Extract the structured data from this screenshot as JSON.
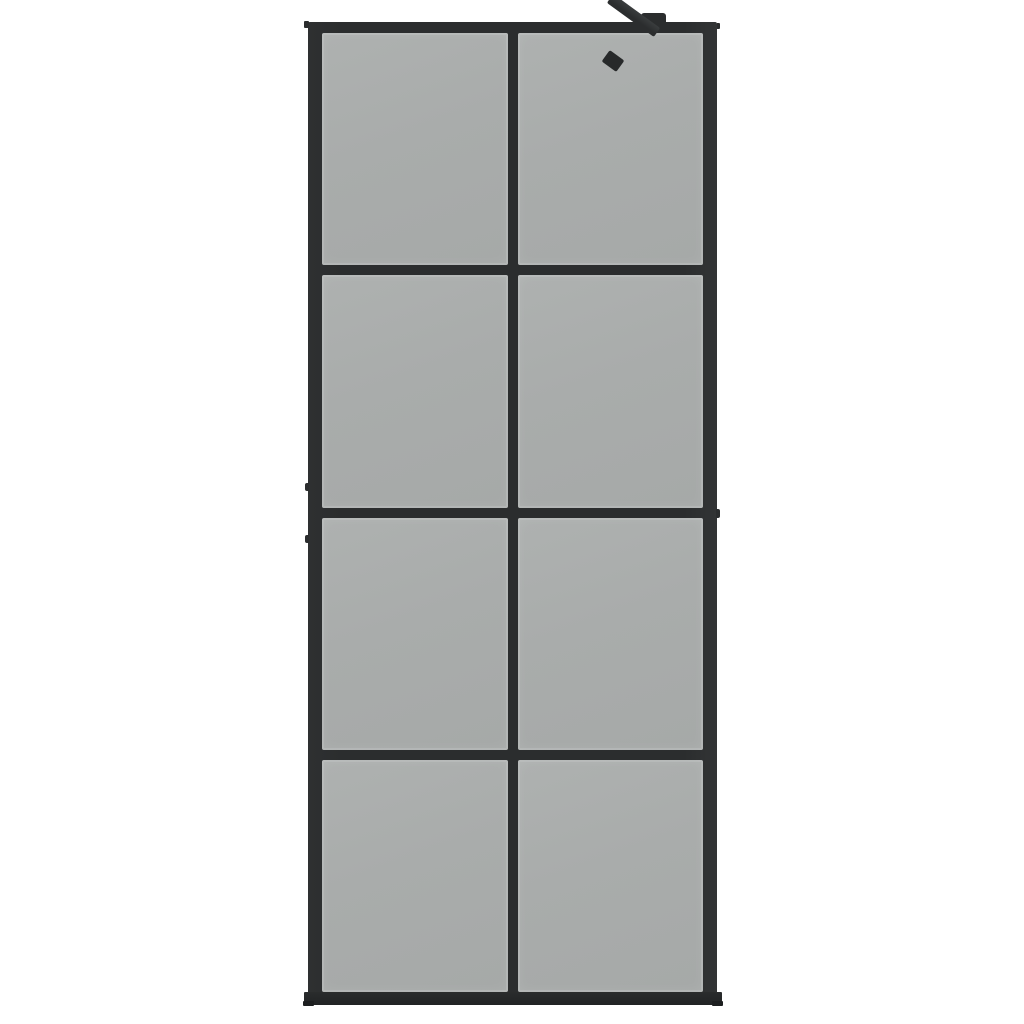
{
  "scene": {
    "description": "Product photo of a walk-in shower screen with a black aluminium frame and dark smoked glass, shown on a plain white background",
    "background_color": "#ffffff"
  },
  "colors": {
    "background": "#ffffff",
    "frame": "#2b2d2e",
    "frame_dark": "#212324",
    "frame_highlight": "#3a3d3e",
    "glass": "#a9acab",
    "glass_edge": "#b8bab9"
  },
  "screen": {
    "type": "walk-in-shower-glass-screen",
    "rows": 4,
    "columns": 2,
    "pane_count": 8,
    "hardware": [
      {
        "name": "wall-bracket",
        "position": "top-right, on top of frame"
      },
      {
        "name": "support-arm",
        "position": "diagonal, from wall bracket down-left into glass"
      },
      {
        "name": "support-arm-end-cap",
        "position": "lower end of support arm"
      },
      {
        "name": "bottom-base-bar",
        "position": "full width under frame, slightly wider than frame"
      },
      {
        "name": "wall-mount-nub",
        "position": "left outer edge, upper-middle"
      },
      {
        "name": "wall-mount-nub",
        "position": "left outer edge, middle"
      },
      {
        "name": "wall-mount-nub",
        "position": "right outer edge, middle rail junction"
      }
    ]
  }
}
